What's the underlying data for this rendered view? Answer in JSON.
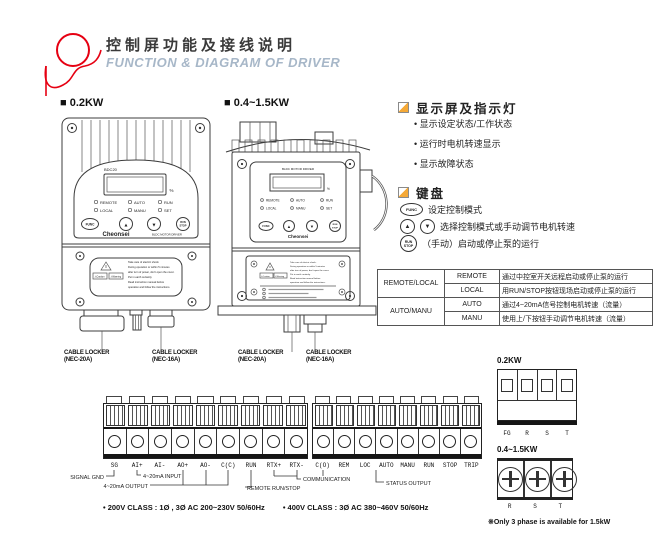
{
  "colors": {
    "brand_red": "#e60012",
    "subtitle_blue_gray": "#a7b7c8",
    "icon_orange": "#f5a937"
  },
  "header": {
    "title_zh": "控制屏功能及接线说明",
    "title_en": "FUNCTION & DIAGRAM OF DRIVER"
  },
  "devices": {
    "small_label": "■ 0.2KW",
    "large_label": "■ 0.4~1.5KW",
    "brand": "Cheonsei",
    "brand_sub": "BLDC MOTOR DRIVER",
    "model": "BDC20",
    "percent": "%",
    "panel_title": "BLDC MOTOR DRIVER",
    "leds": [
      "REMOTE",
      "AUTO",
      "RUN",
      "LOCAL",
      "MANU",
      "SET"
    ],
    "btn_func": "FUNC",
    "btn_up": "▲",
    "btn_down": "▼",
    "btn_run": "RUN",
    "btn_stop": "STOP",
    "caution": "⚠Caution",
    "warning": "⚠Warning",
    "warning_lines": [
      "Take care of electric shock.",
      "During operation or within 5 minutes",
      "after turn of power, don't open the cover.",
      "Put in earth certainly.",
      "Read instruction manual before",
      "operation and follow the instructions."
    ],
    "cable_lockers": [
      {
        "l1": "CABLE LOCKER",
        "l2": "(NEC-20A)"
      },
      {
        "l1": "CABLE LOCKER",
        "l2": "(NEC-16A)"
      },
      {
        "l1": "CABLE LOCKER",
        "l2": "(NEC-20A)"
      },
      {
        "l1": "CABLE LOCKER",
        "l2": "(NEC-16A)"
      }
    ]
  },
  "display_section": {
    "title": "显示屏及指示灯",
    "bullets": [
      "显示设定状态/工作状态",
      "运行时电机转速显示",
      "显示故障状态"
    ]
  },
  "keypad_section": {
    "title": "键盘",
    "items": [
      {
        "text": "设定控制模式"
      },
      {
        "text": "选择控制模式或手动调节电机转速"
      },
      {
        "text": "（手动）启动或停止泵的运行"
      }
    ]
  },
  "mode_table": {
    "rows": [
      {
        "group": "REMOTE/LOCAL",
        "mode": "REMOTE",
        "desc": "通过中控室开关远程启动或停止泵的运行"
      },
      {
        "group": "",
        "mode": "LOCAL",
        "desc": "用RUN/STOP按钮现场启动或停止泵的运行"
      },
      {
        "group": "AUTO/MANU",
        "mode": "AUTO",
        "desc": "通过4~20mA信号控制电机转速（流量）"
      },
      {
        "group": "",
        "mode": "MANU",
        "desc": "使用上/下按钮手动调节电机转速（流量）"
      }
    ]
  },
  "wiring": {
    "left_terminals": [
      "SG",
      "AI+",
      "AI-",
      "AO+",
      "AO-",
      "C(C)",
      "RUN",
      "RTX+",
      "RTX-"
    ],
    "right_terminals": [
      "C(O)",
      "REM",
      "LOC",
      "AUTO",
      "MANU",
      "RUN",
      "STOP",
      "TRIP"
    ],
    "ann_signal": "SIGNAL GND",
    "ann_input": "4~20mA INPUT",
    "ann_output": "4~20mA OUTPUT",
    "ann_remote": "REMOTE RUN/STOP",
    "ann_comm": "COMMUNICATION",
    "ann_status": "STATUS OUTPUT",
    "note_200": "• 200V CLASS : 1Ø , 3Ø  AC 200~230V 50/60Hz",
    "note_400": "• 400V CLASS : 3Ø  AC 380~460V 50/60Hz"
  },
  "power": {
    "small_label": "0.2KW",
    "small_terminals": [
      "FG",
      "R",
      "S",
      "T"
    ],
    "large_label": "0.4~1.5KW",
    "large_terminals": [
      "R",
      "S",
      "T"
    ],
    "note": "※Only 3 phase is available for 1.5kW"
  }
}
